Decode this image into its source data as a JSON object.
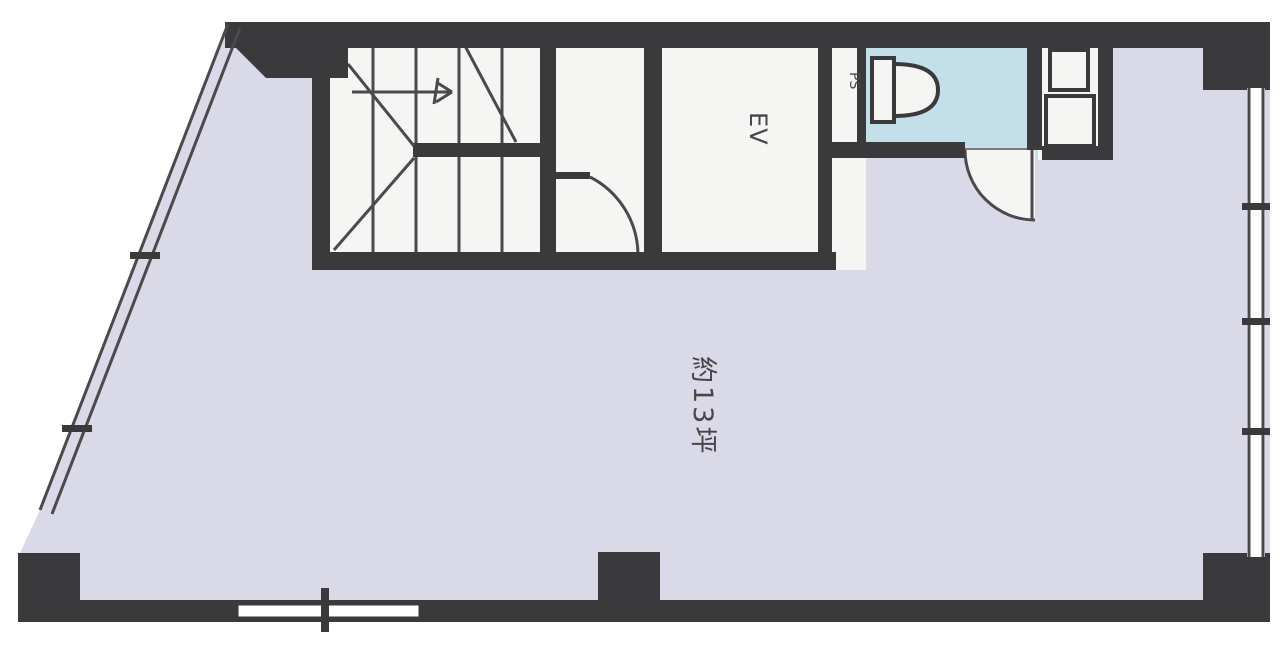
{
  "title": "building-floor-plan",
  "colors": {
    "page-bg": "#ffffff",
    "wall": "#3a3a3c",
    "line": "#4a4a4c",
    "room-main": "#d9d9e7",
    "room-toilet": "#c3dfe9",
    "room-white": "#f5f5f4",
    "text": "#474747"
  },
  "labels": {
    "main_room_area": "約13坪",
    "elevator": "EV",
    "pipe_space": "PS"
  }
}
